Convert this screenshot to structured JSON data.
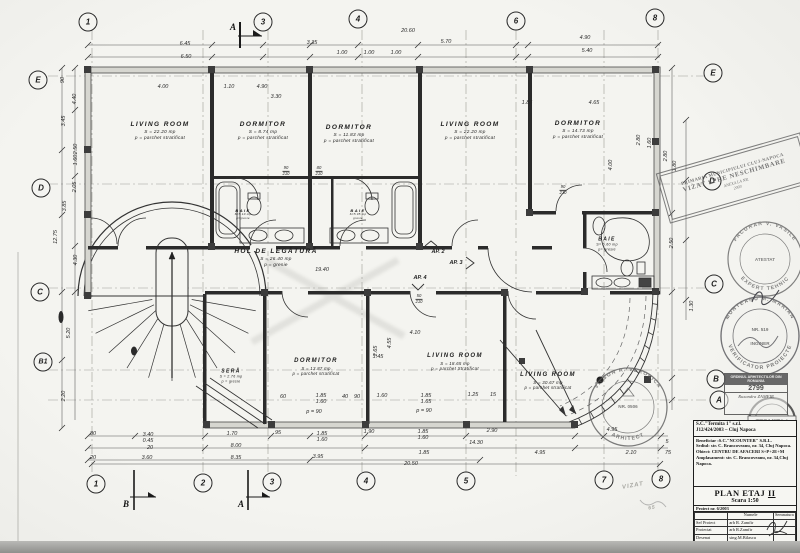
{
  "plan": {
    "drawing_type": "floor plan",
    "paper_color": "#f4f4f0",
    "ink_color": "#2b2b2b"
  },
  "grid_markers": [
    {
      "label": "1",
      "x": 88,
      "y": 22
    },
    {
      "label": "3",
      "x": 263,
      "y": 22
    },
    {
      "label": "4",
      "x": 358,
      "y": 19
    },
    {
      "label": "6",
      "x": 516,
      "y": 21
    },
    {
      "label": "8",
      "x": 655,
      "y": 18
    },
    {
      "label": "1",
      "x": 96,
      "y": 484
    },
    {
      "label": "2",
      "x": 203,
      "y": 483
    },
    {
      "label": "3",
      "x": 272,
      "y": 482
    },
    {
      "label": "4",
      "x": 366,
      "y": 481
    },
    {
      "label": "5",
      "x": 466,
      "y": 481
    },
    {
      "label": "7",
      "x": 604,
      "y": 480
    },
    {
      "label": "8",
      "x": 661,
      "y": 479
    },
    {
      "label": "E",
      "x": 38,
      "y": 80
    },
    {
      "label": "D",
      "x": 41,
      "y": 188
    },
    {
      "label": "C",
      "x": 40,
      "y": 292
    },
    {
      "label": "B1",
      "x": 43,
      "y": 362
    },
    {
      "label": "E",
      "x": 713,
      "y": 73
    },
    {
      "label": "D",
      "x": 712,
      "y": 181
    },
    {
      "label": "C",
      "x": 714,
      "y": 284
    },
    {
      "label": "B",
      "x": 716,
      "y": 379
    },
    {
      "label": "A",
      "x": 719,
      "y": 400
    }
  ],
  "section_marks": [
    {
      "label": "A",
      "x": 233,
      "y": 27
    },
    {
      "label": "B",
      "x": 126,
      "y": 504
    },
    {
      "label": "A",
      "x": 241,
      "y": 504
    }
  ],
  "rooms": [
    {
      "name": "LIVING ROOM",
      "area": "S = 22.20 mp",
      "floor": "p = parchet stratificat",
      "x": 160,
      "y": 131,
      "size": 6.5
    },
    {
      "name": "DORMITOR",
      "area": "S = 8.74 mp",
      "floor": "p = parchet stratificat",
      "x": 263,
      "y": 131,
      "size": 6.5
    },
    {
      "name": "DORMITOR",
      "area": "S = 11.83 mp",
      "floor": "p = parchet stratificat",
      "x": 349,
      "y": 134,
      "size": 6.5
    },
    {
      "name": "LIVING ROOM",
      "area": "S = 22.20 mp",
      "floor": "p = parchet stratificat",
      "x": 470,
      "y": 131,
      "size": 6.5
    },
    {
      "name": "DORMITOR",
      "area": "S = 14.73 mp",
      "floor": "p = parchet stratificat",
      "x": 578,
      "y": 130,
      "size": 6.5
    },
    {
      "name": "HOL DE LEGĂTURĂ",
      "area": "S = 26.40 mp",
      "floor": "p = gresie",
      "x": 276,
      "y": 258,
      "size": 6.5
    },
    {
      "name": "BAIE",
      "area": "S=5.10 mp",
      "floor": "p=gresie",
      "x": 243,
      "y": 214,
      "size": 4
    },
    {
      "name": "BAIE",
      "area": "S=5.05 mp",
      "floor": "gresie",
      "x": 358,
      "y": 214,
      "size": 4
    },
    {
      "name": "BAIE",
      "area": "S= 6.60 mp",
      "floor": "p= gresie",
      "x": 607,
      "y": 244,
      "size": 5
    },
    {
      "name": "SERĂ",
      "area": "S = 2.76 mp",
      "floor": "p = gresie",
      "x": 231,
      "y": 376,
      "size": 5
    },
    {
      "name": "DORMITOR",
      "area": "S = 13.87 mp",
      "floor": "p = parchet stratificat",
      "x": 316,
      "y": 367,
      "size": 6
    },
    {
      "name": "LIVING ROOM",
      "area": "S = 18.65 mp",
      "floor": "p = parchet Stratificat",
      "x": 455,
      "y": 362,
      "size": 6
    },
    {
      "name": "LIVING ROOM",
      "area": "S = 30.67 mp",
      "floor": "p = parchet stratificat",
      "x": 548,
      "y": 381,
      "size": 6
    }
  ],
  "ap_labels": [
    {
      "label": "AP. 2",
      "x": 438,
      "y": 252
    },
    {
      "label": "AP. 3",
      "x": 456,
      "y": 263
    },
    {
      "label": "AP. 4",
      "x": 420,
      "y": 278
    }
  ],
  "door_tags": [
    {
      "top": "90",
      "bot": "210",
      "x": 286,
      "y": 171
    },
    {
      "top": "80",
      "bot": "210",
      "x": 319,
      "y": 171
    },
    {
      "top": "90",
      "bot": "210",
      "x": 563,
      "y": 190
    },
    {
      "top": "50",
      "bot": "210",
      "x": 419,
      "y": 299
    }
  ],
  "dimensions": [
    {
      "v": "6.45",
      "x": 185,
      "y": 44
    },
    {
      "v": "6.50",
      "x": 186,
      "y": 57
    },
    {
      "v": "3.35",
      "x": 312,
      "y": 43
    },
    {
      "v": "1.00",
      "x": 342,
      "y": 53
    },
    {
      "v": "1.00",
      "x": 369,
      "y": 53
    },
    {
      "v": "1.00",
      "x": 396,
      "y": 53
    },
    {
      "v": "20.60",
      "x": 408,
      "y": 31
    },
    {
      "v": "5.70",
      "x": 446,
      "y": 42
    },
    {
      "v": "4.90",
      "x": 585,
      "y": 38
    },
    {
      "v": "5.40",
      "x": 587,
      "y": 51
    },
    {
      "v": "4.00",
      "x": 163,
      "y": 87
    },
    {
      "v": "1.10",
      "x": 229,
      "y": 87
    },
    {
      "v": "4.90",
      "x": 262,
      "y": 87
    },
    {
      "v": "3.30",
      "x": 276,
      "y": 97
    },
    {
      "v": "1.85",
      "x": 527,
      "y": 103
    },
    {
      "v": "4.65",
      "x": 594,
      "y": 103
    },
    {
      "v": "90",
      "x": 63,
      "y": 80,
      "r": 1
    },
    {
      "v": "4.40",
      "x": 75,
      "y": 99,
      "r": 1
    },
    {
      "v": "3.45",
      "x": 64,
      "y": 121,
      "r": 1
    },
    {
      "v": "2.50",
      "x": 76,
      "y": 149,
      "r": 1
    },
    {
      "v": "1.60",
      "x": 76,
      "y": 160,
      "r": 1
    },
    {
      "v": "2.05",
      "x": 75,
      "y": 187,
      "r": 1
    },
    {
      "v": "3.85",
      "x": 65,
      "y": 206,
      "r": 1
    },
    {
      "v": "12.75",
      "x": 56,
      "y": 237,
      "r": 1
    },
    {
      "v": "4.30",
      "x": 76,
      "y": 260,
      "r": 1
    },
    {
      "v": "5.20",
      "x": 69,
      "y": 333,
      "r": 1
    },
    {
      "v": "2.20",
      "x": 64,
      "y": 396,
      "r": 1
    },
    {
      "v": "4.00",
      "x": 611,
      "y": 165,
      "r": 1
    },
    {
      "v": "2.80",
      "x": 639,
      "y": 140,
      "r": 1
    },
    {
      "v": "1.60",
      "x": 650,
      "y": 143,
      "r": 1
    },
    {
      "v": "2.80",
      "x": 666,
      "y": 156,
      "r": 1
    },
    {
      "v": "1.80",
      "x": 675,
      "y": 166,
      "r": 1
    },
    {
      "v": "2.50",
      "x": 672,
      "y": 243,
      "r": 1
    },
    {
      "v": "1.30",
      "x": 692,
      "y": 306,
      "r": 1
    },
    {
      "v": "80",
      "x": 93,
      "y": 434
    },
    {
      "v": "20",
      "x": 93,
      "y": 458
    },
    {
      "v": "3.40",
      "x": 148,
      "y": 435
    },
    {
      "v": "0.45",
      "x": 148,
      "y": 441
    },
    {
      "v": "20",
      "x": 150,
      "y": 448
    },
    {
      "v": "3.60",
      "x": 147,
      "y": 458
    },
    {
      "v": "1.70",
      "x": 232,
      "y": 434
    },
    {
      "v": "8.00",
      "x": 236,
      "y": 446
    },
    {
      "v": "8.35",
      "x": 236,
      "y": 458
    },
    {
      "v": "95",
      "x": 278,
      "y": 433
    },
    {
      "v": "1.85",
      "x": 322,
      "y": 434
    },
    {
      "v": "1.60",
      "x": 322,
      "y": 440
    },
    {
      "v": "3.95",
      "x": 318,
      "y": 457
    },
    {
      "v": "1.90",
      "x": 369,
      "y": 432
    },
    {
      "v": "1.85",
      "x": 423,
      "y": 432
    },
    {
      "v": "1.60",
      "x": 423,
      "y": 438
    },
    {
      "v": "2.90",
      "x": 492,
      "y": 431
    },
    {
      "v": "14.30",
      "x": 476,
      "y": 443
    },
    {
      "v": "1.85",
      "x": 424,
      "y": 453
    },
    {
      "v": "4.95",
      "x": 540,
      "y": 453
    },
    {
      "v": "20.50",
      "x": 411,
      "y": 464
    },
    {
      "v": "4.95",
      "x": 612,
      "y": 430
    },
    {
      "v": "5",
      "x": 667,
      "y": 442
    },
    {
      "v": "2.10",
      "x": 631,
      "y": 453
    },
    {
      "v": "75",
      "x": 668,
      "y": 453
    },
    {
      "v": "19.40",
      "x": 322,
      "y": 270
    },
    {
      "v": "60",
      "x": 283,
      "y": 397
    },
    {
      "v": "1.85",
      "x": 321,
      "y": 396
    },
    {
      "v": "1.60",
      "x": 321,
      "y": 402
    },
    {
      "v": "40",
      "x": 345,
      "y": 397
    },
    {
      "v": "90",
      "x": 357,
      "y": 397
    },
    {
      "v": "1.60",
      "x": 382,
      "y": 396
    },
    {
      "v": "1.85",
      "x": 426,
      "y": 396
    },
    {
      "v": "1.65",
      "x": 426,
      "y": 402
    },
    {
      "v": "1.25",
      "x": 473,
      "y": 395
    },
    {
      "v": "15",
      "x": 493,
      "y": 395
    },
    {
      "v": "p = 90",
      "x": 314,
      "y": 412
    },
    {
      "v": "p = 90",
      "x": 424,
      "y": 411
    },
    {
      "v": "2.65",
      "x": 376,
      "y": 351,
      "r": 1
    },
    {
      "v": "4.55",
      "x": 390,
      "y": 343,
      "r": 1
    },
    {
      "v": "4.10",
      "x": 415,
      "y": 333
    },
    {
      "v": "1.45",
      "x": 378,
      "y": 357
    }
  ],
  "stamps": {
    "vizat": {
      "line1": "PRIMARIA MUNICIPIULUI CLUJ-NAPOCA",
      "line2": "VIZAT SPRE NESCHIMBARE",
      "line3": "ANEXA LA NR.",
      "line4": "2003"
    },
    "facurar": {
      "top": "FACURAR V. VASILE",
      "bottom": "EXPERT TEHNIC",
      "center": "ATESTAT"
    },
    "munteanu": {
      "top": "MUNTEANU M. MARIAN",
      "bottom": "VERIFICATOR PROIECTE",
      "center": "NR. 519",
      "mid": "INGINER"
    },
    "vilson": {
      "top": "VILSON R. VERONICA",
      "bottom": "ARHITECT",
      "center": "NR. 0506"
    },
    "termita": {
      "label": "TERMITA 1"
    },
    "oar": {
      "header": "ORDINUL ARHITECTILOR DIN ROMANIA",
      "number": "2799",
      "name": "Ruxandra ZAMFIR"
    },
    "pencil": {
      "vizat": "VIZAT",
      "num": "65"
    }
  },
  "title_block": {
    "company": [
      "S.C.\"Termita 1\" s.r.l.",
      "J12/424/2003 – Cluj Napoca"
    ],
    "info": [
      "Beneficiar :S.C.\"NCOUNTER\" S.R.L.",
      "Sediul: str. C. Brancoveanu, nr. 34, Cluj Napoca.",
      "Obiect: CENTRU DE AFACERI S+P+2E+M",
      "Amplasament: str. C. Brancoveanu, nr. 34,Cluj Napoca."
    ],
    "plan_title": "PLAN ETAJ",
    "plan_stage": "II",
    "scale": "Scara 1:50",
    "project": "Proiect nr. 6/2003",
    "col_name": "Numele",
    "col_sign": "Semnatura",
    "rows": [
      [
        "Sef Proiect",
        "arh R. Zamfir"
      ],
      [
        "Proiectat",
        "arh R.Zamfir"
      ],
      [
        "Desenat",
        "sing.M.Bilascu"
      ]
    ],
    "date_row": [
      "Data :",
      "mai. 2003",
      "A"
    ]
  }
}
